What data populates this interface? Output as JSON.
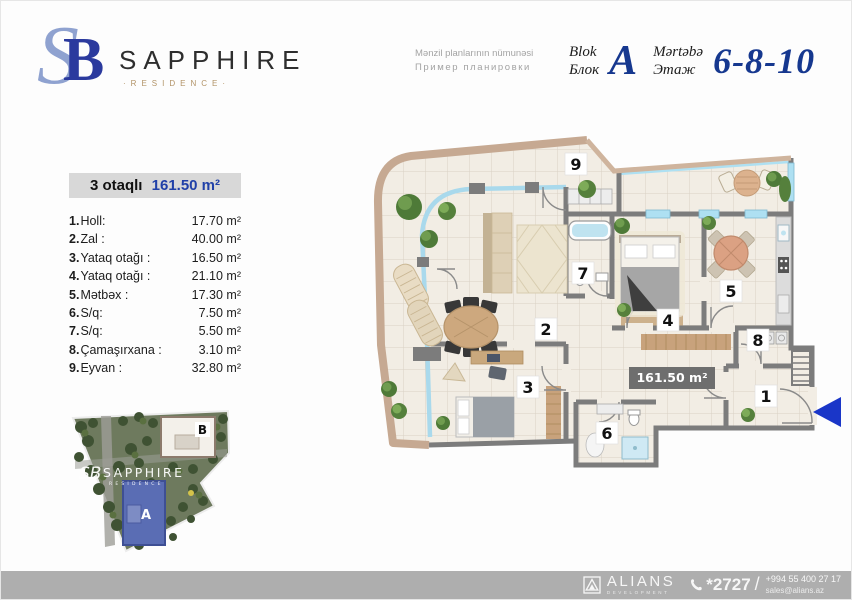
{
  "brand": {
    "monogram_s": "S",
    "monogram_b": "B",
    "name": "SAPPHIRE",
    "subtitle": "·RESIDENCE·"
  },
  "header": {
    "note_line1": "Mənzil planlarının nümunəsi",
    "note_line2": "Пример планировки",
    "block_label_az": "Blok",
    "block_label_ru": "Блок",
    "block_value": "A",
    "floor_label_az": "Mərtəbə",
    "floor_label_ru": "Этаж",
    "floor_value": "6-8-10"
  },
  "apartment": {
    "type_label": "3 otaqlı",
    "total_area": "161.50 m²",
    "rooms": [
      {
        "num": "1",
        "name": "Holl:",
        "area": "17.70 m²"
      },
      {
        "num": "2",
        "name": "Zal :",
        "area": "40.00 m²"
      },
      {
        "num": "3",
        "name": "Yataq otağı :",
        "area": "16.50 m²"
      },
      {
        "num": "4",
        "name": "Yataq otağı :",
        "area": "21.10 m²"
      },
      {
        "num": "5",
        "name": "Mətbəx :",
        "area": "17.30 m²"
      },
      {
        "num": "6",
        "name": "S/q:",
        "area": "7.50 m²"
      },
      {
        "num": "7",
        "name": "S/q:",
        "area": "5.50 m²"
      },
      {
        "num": "8",
        "name": "Çamaşırxana :",
        "area": "3.10 m²"
      },
      {
        "num": "9",
        "name": "Eyvan :",
        "area": "32.80 m²"
      }
    ]
  },
  "floorplan": {
    "area_badge": "161.50 m²",
    "room_numbers": [
      "1",
      "2",
      "3",
      "4",
      "5",
      "6",
      "7",
      "8",
      "9"
    ]
  },
  "sitemap": {
    "watermark_monogram": "SB",
    "watermark": "SAPPHIRE",
    "watermark_sub": "RESIDENCE",
    "building_a": "A",
    "building_b": "B"
  },
  "footer": {
    "logo_text": "ALIANS",
    "logo_sub": "DEVELOPMENT",
    "phone_short": "*2727",
    "separator": "/",
    "phone_full": "+994 55 400 27 17",
    "email": "sales@alians.az"
  },
  "colors": {
    "accent_blue": "#16388f",
    "logo_blue": "#2b3a9e",
    "balcony_wall_beige": "#c6a992",
    "interior_wall_gray": "#7c7c7c",
    "window_blue": "#aee0f2",
    "entrance_arrow_blue": "#1a36c8",
    "footer_gray": "#aeaeae"
  }
}
